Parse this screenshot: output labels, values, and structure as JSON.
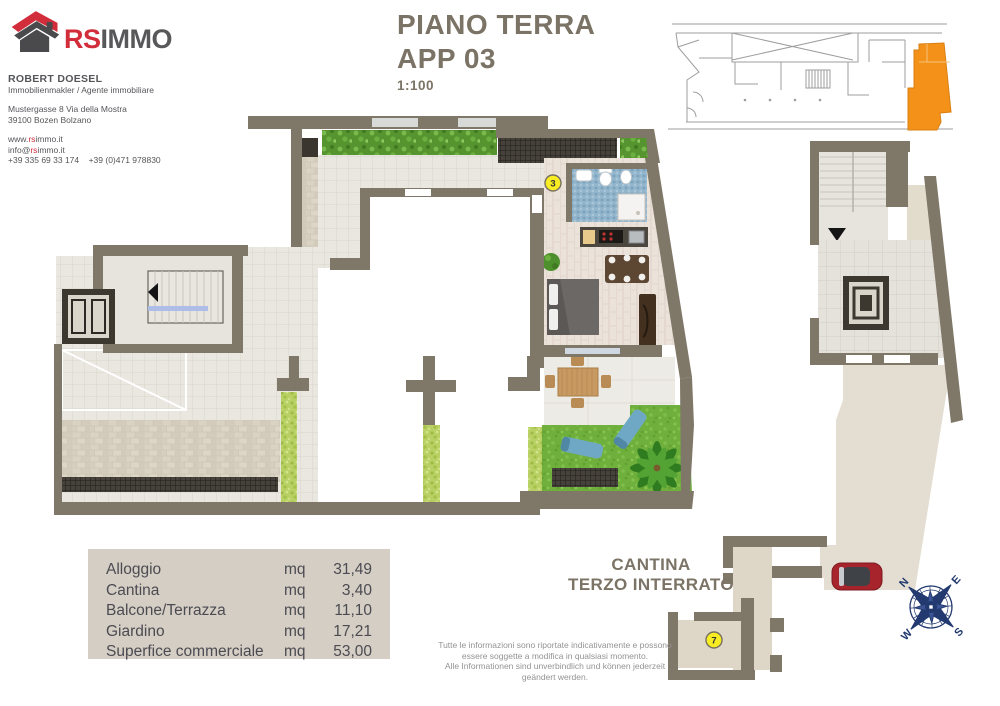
{
  "header": {
    "logo": {
      "brand_red": "RS",
      "brand_dark": "IMMO"
    },
    "agent_name": "ROBERT DOESEL",
    "agent_role": "Immobilienmakler / Agente immobiliare",
    "address_line1": "Mustergasse 8 Via della Mostra",
    "address_line2": "39100 Bozen Bolzano",
    "website": {
      "prefix": "www.",
      "accent": "rs",
      "rest": "immo.it"
    },
    "email": {
      "prefix": "info@",
      "accent": "rs",
      "rest": "immo.it"
    },
    "phones": "+39 335 69 33 174    +39 (0)471 978830"
  },
  "title": {
    "line1": "PIANO TERRA",
    "line2": "APP 03",
    "scale": "1:100"
  },
  "floor_plan": {
    "apartment_marker": "3",
    "cellar_marker": "7"
  },
  "cellar_label": {
    "line1": "CANTINA",
    "line2": "TERZO INTERRATO"
  },
  "area_table": {
    "rows": [
      {
        "label": "Alloggio",
        "unit": "mq",
        "value": "31,49"
      },
      {
        "label": "Cantina",
        "unit": "mq",
        "value": "3,40"
      },
      {
        "label": "Balcone/Terrazza",
        "unit": "mq",
        "value": "11,10"
      },
      {
        "label": "Giardino",
        "unit": "mq",
        "value": "17,21"
      },
      {
        "label": "Superfice commerciale",
        "unit": "mq",
        "value": "53,00"
      }
    ]
  },
  "disclaimer": {
    "line1": "Tutte le informazioni sono riportate indicativamente e possono",
    "line2": "essere soggette a modifica in qualsiasi momento.",
    "line3": "Alle Informationen sind unverbindlich und können jederzeit",
    "line4": "geändert werden."
  },
  "compass": {
    "n": "N",
    "e": "E",
    "s": "S",
    "w": "W"
  },
  "colors": {
    "accent_red": "#d22d3a",
    "brand_gray": "#58585a",
    "title_brown": "#7b7365",
    "wall_taupe": "#7f7768",
    "highlight_orange": "#f39119",
    "marker_yellow": "#f8ed22",
    "compass_navy": "#223a70",
    "table_bg": "#d5cec5"
  }
}
